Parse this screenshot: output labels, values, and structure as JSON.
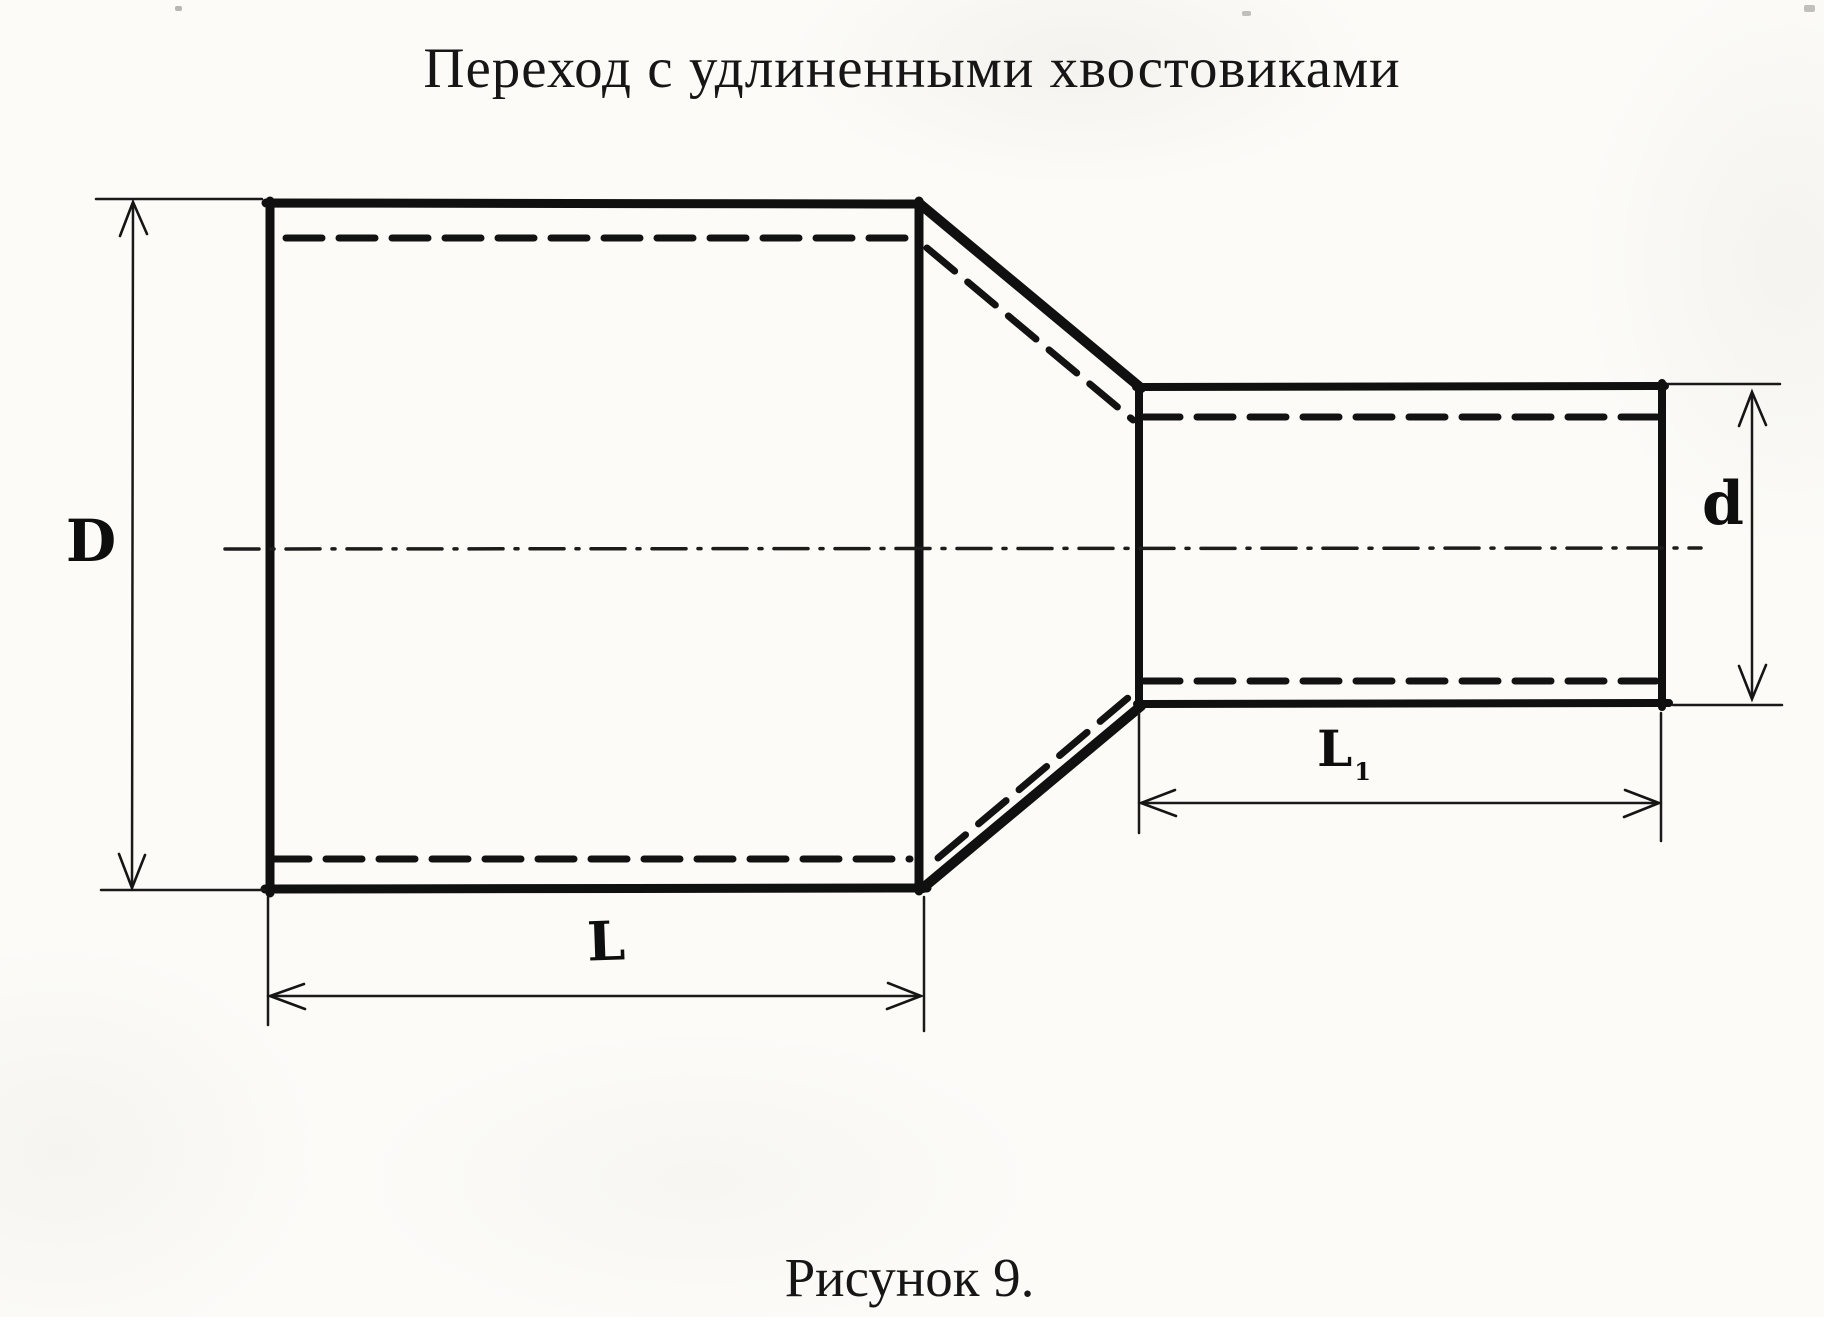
{
  "title": "Переход с удлиненными хвостовиками",
  "caption": "Рисунок 9.",
  "drawing": {
    "labels": {
      "large_diameter": "D",
      "small_diameter": "d",
      "large_length": "L",
      "small_length_main": "L",
      "small_length_sub": "1"
    },
    "colors": {
      "ink": "#111111",
      "paper": "#fcfbf8"
    }
  }
}
